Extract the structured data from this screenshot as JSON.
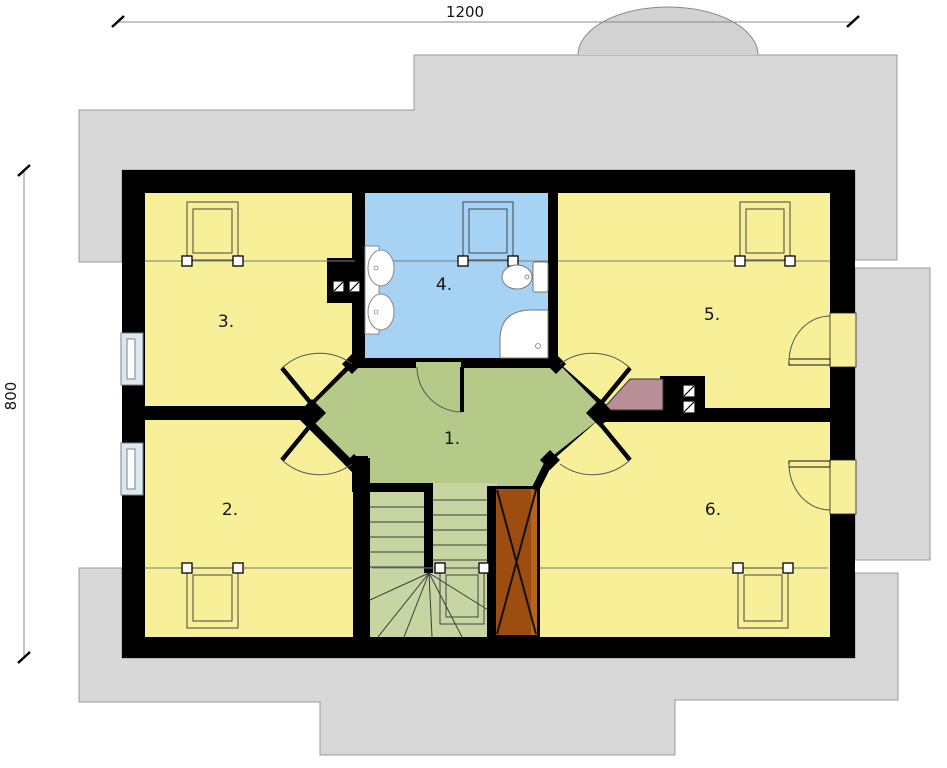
{
  "plan": {
    "type": "attic-floor-plan",
    "dimension_labels": {
      "width": "1200",
      "height": "800"
    },
    "rooms": [
      {
        "number": "1.",
        "fill": "#b5ca88",
        "kind": "hall"
      },
      {
        "number": "2.",
        "fill": "#f7f099",
        "kind": "room"
      },
      {
        "number": "3.",
        "fill": "#f7f099",
        "kind": "room"
      },
      {
        "number": "4.",
        "fill": "#a6d3f3",
        "kind": "bathroom"
      },
      {
        "number": "5.",
        "fill": "#f7f099",
        "kind": "room"
      },
      {
        "number": "6.",
        "fill": "#f7f099",
        "kind": "room"
      }
    ],
    "colors": {
      "roof": "#d8d8d8",
      "walls": "#000000",
      "stairs": "#c7d5a2",
      "window_glazing": "#dde9ee",
      "door_panel_brown": "#9d4d0f",
      "door_panel_brown_light": "#b4651d",
      "counter_pink": "#b98f97"
    },
    "fixtures": [
      "washbasin",
      "washbasin",
      "toilet",
      "corner-shower",
      "staircase",
      "roof-window",
      "roof-window",
      "roof-window",
      "roof-window",
      "roof-window",
      "roof-window"
    ]
  }
}
